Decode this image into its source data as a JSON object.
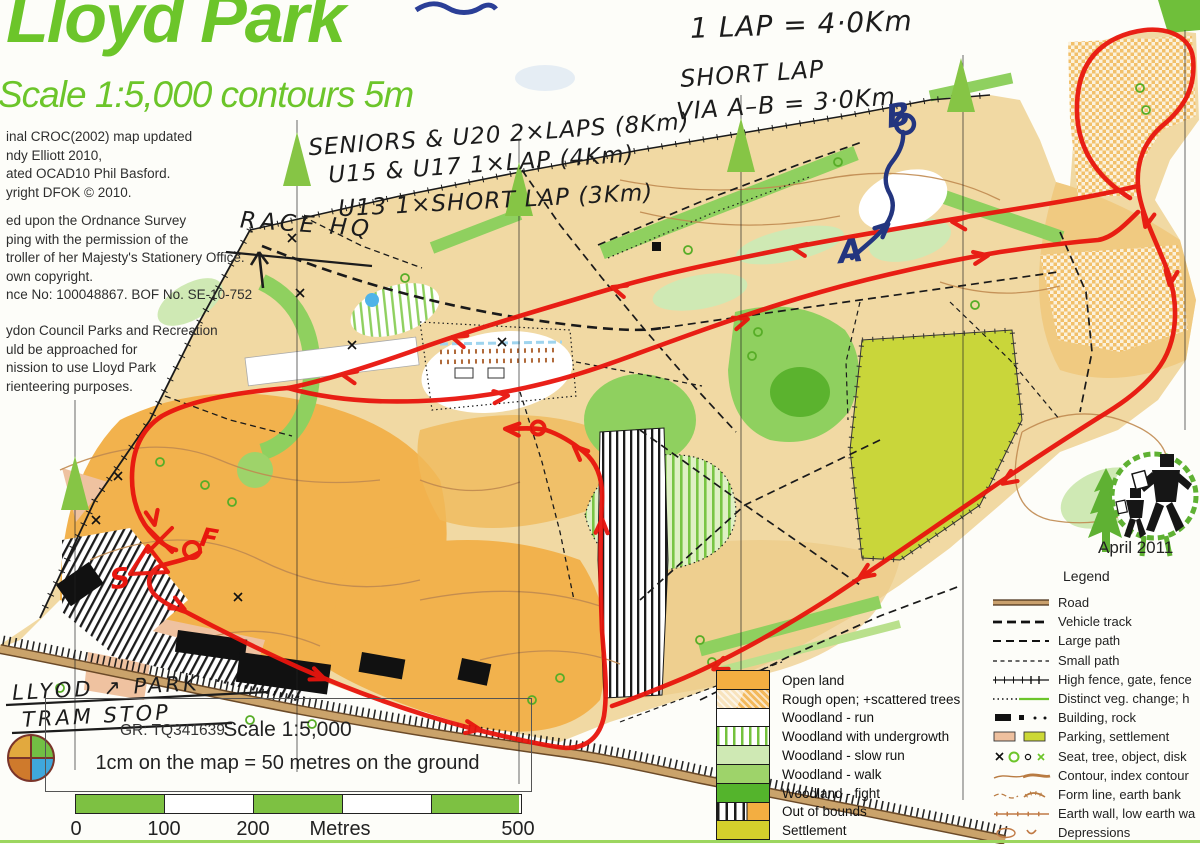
{
  "header": {
    "title": "Lloyd Park",
    "subtitle": "Scale 1:5,000  contours 5m"
  },
  "credits": {
    "block1": [
      "inal CROC(2002) map updated",
      "ndy Elliott 2010,",
      "ated OCAD10 Phil Basford.",
      "yright DFOK © 2010."
    ],
    "block2": [
      "ed upon the Ordnance Survey",
      "ping with the permission of the",
      "troller of her Majesty's Stationery Office.",
      "own copyright.",
      "nce No: 100048867. BOF No. SE-10-752"
    ],
    "block3": [
      "ydon Council Parks and Recreation",
      "uld be approached for",
      "nission to use Lloyd Park",
      "rienteering purposes."
    ]
  },
  "annotations": {
    "lap": "1 LAP = 4·0Km",
    "short_lap_1": "SHORT LAP",
    "short_lap_2": "VIA A–B = 3·0Km",
    "class_1": "SENIORS & U20  2×LAPS (8Km)",
    "class_2": "U15 & U17    1×LAP  (4Km)",
    "class_3": "U13 1×SHORT LAP (3Km)",
    "race_hq": "RACE HQ",
    "tram_1": "LLYOD ↗ PARK",
    "tram_2": "TRAM STOP",
    "grid_ref": "GR: TQ341639",
    "a": "A",
    "b": "B",
    "s": "S",
    "f": "F"
  },
  "logo": {
    "date": "April 2011"
  },
  "legend_panel": {
    "heading": "Legend",
    "items": [
      "Road",
      "Vehicle track",
      "Large path",
      "Small path",
      "High fence, gate, fence",
      "Distinct veg. change; h",
      "Building, rock",
      "Parking, settlement",
      "Seat, tree, object, disk",
      "Contour, index contour",
      "Form line, earth bank",
      "Earth wall, low earth wa",
      "Depressions"
    ]
  },
  "terrain_legend": {
    "items": [
      "Open land",
      "Rough open; +scattered trees",
      "Woodland - run",
      "Woodland with undergrowth",
      "Woodland - slow run",
      "Woodland - walk",
      "Woodland - fight",
      "Out of bounds",
      "Settlement"
    ]
  },
  "scalebar": {
    "title": "Scale 1:5,000",
    "subtitle": "1cm on the map = 50 metres on the ground",
    "t0": "0",
    "t100": "100",
    "t200": "200",
    "tmid": "Metres",
    "t500": "500"
  },
  "colors": {
    "map_green_title": "#6cc52a",
    "open_land": "#f3ae41",
    "tan": "#f1d9a3",
    "route_red": "#e8150d",
    "pen_blue": "#23357f",
    "road_brown": "#c9a06d"
  }
}
